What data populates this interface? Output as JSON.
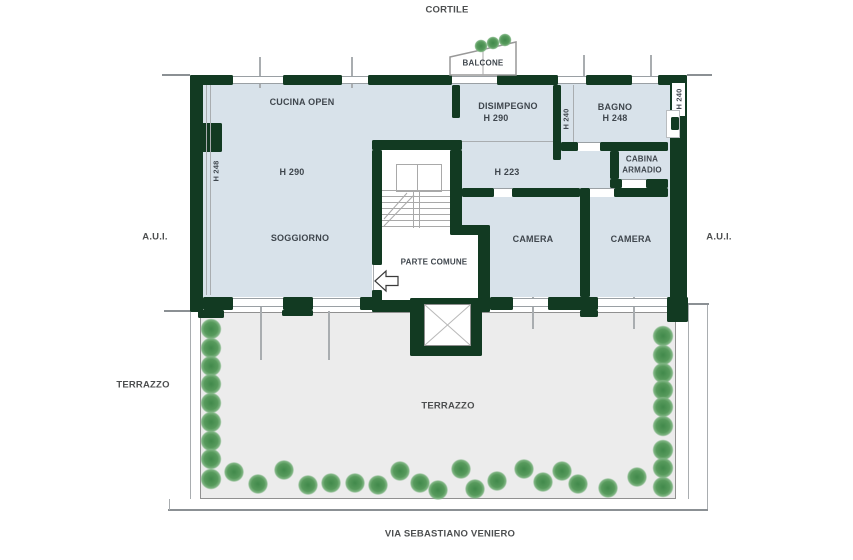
{
  "colors": {
    "wall": "#123a22",
    "room_fill": "#d8e2ea",
    "terrace_fill": "#ececec",
    "terrace_border": "#909090",
    "tree_green": "#41894b",
    "line_gray": "#9aa0a4"
  },
  "surroundings": {
    "top": "CORTILE",
    "bottom_street": "VIA SEBASTIANO VENIERO",
    "left_area": "A.U.I.",
    "right_area": "A.U.I.",
    "terrace_left": "TERRAZZO"
  },
  "rooms": {
    "balcone": "BALCONE",
    "cucina": "CUCINA OPEN",
    "disimpegno": "DISIMPEGNO",
    "disimpegno_h": "H 290",
    "bagno": "BAGNO",
    "bagno_h": "H 248",
    "cabina_line1": "CABINA",
    "cabina_line2": "ARMADIO",
    "soggiorno": "SOGGIORNO",
    "soggiorno_h": "H 290",
    "corridoio_h": "H 223",
    "camera_1": "CAMERA",
    "camera_2": "CAMERA",
    "parte_comune": "PARTE COMUNE",
    "terrazzo": "TERRAZZO",
    "wall_h_left": "H 248",
    "wall_h_mid": "H 240",
    "wall_h_right": "H 240"
  },
  "trees": {
    "left": [
      [
        211,
        329
      ],
      [
        211,
        348
      ],
      [
        211,
        366
      ],
      [
        211,
        384
      ],
      [
        211,
        403
      ],
      [
        211,
        422
      ],
      [
        211,
        441
      ],
      [
        211,
        459
      ],
      [
        211,
        479
      ]
    ],
    "right": [
      [
        663,
        336
      ],
      [
        663,
        355
      ],
      [
        663,
        373
      ],
      [
        663,
        390
      ],
      [
        663,
        407
      ],
      [
        663,
        426
      ],
      [
        663,
        450
      ],
      [
        663,
        468
      ],
      [
        663,
        487
      ]
    ],
    "bottom": [
      [
        234,
        472
      ],
      [
        258,
        484
      ],
      [
        284,
        470
      ],
      [
        308,
        485
      ],
      [
        331,
        483
      ],
      [
        355,
        483
      ],
      [
        378,
        485
      ],
      [
        400,
        471
      ],
      [
        420,
        483
      ],
      [
        438,
        490
      ],
      [
        461,
        469
      ],
      [
        475,
        489
      ],
      [
        497,
        481
      ],
      [
        524,
        469
      ],
      [
        543,
        482
      ],
      [
        562,
        471
      ],
      [
        578,
        484
      ],
      [
        608,
        488
      ],
      [
        637,
        477
      ]
    ],
    "balcone": [
      [
        481,
        46
      ],
      [
        493,
        43
      ],
      [
        505,
        40
      ]
    ]
  }
}
